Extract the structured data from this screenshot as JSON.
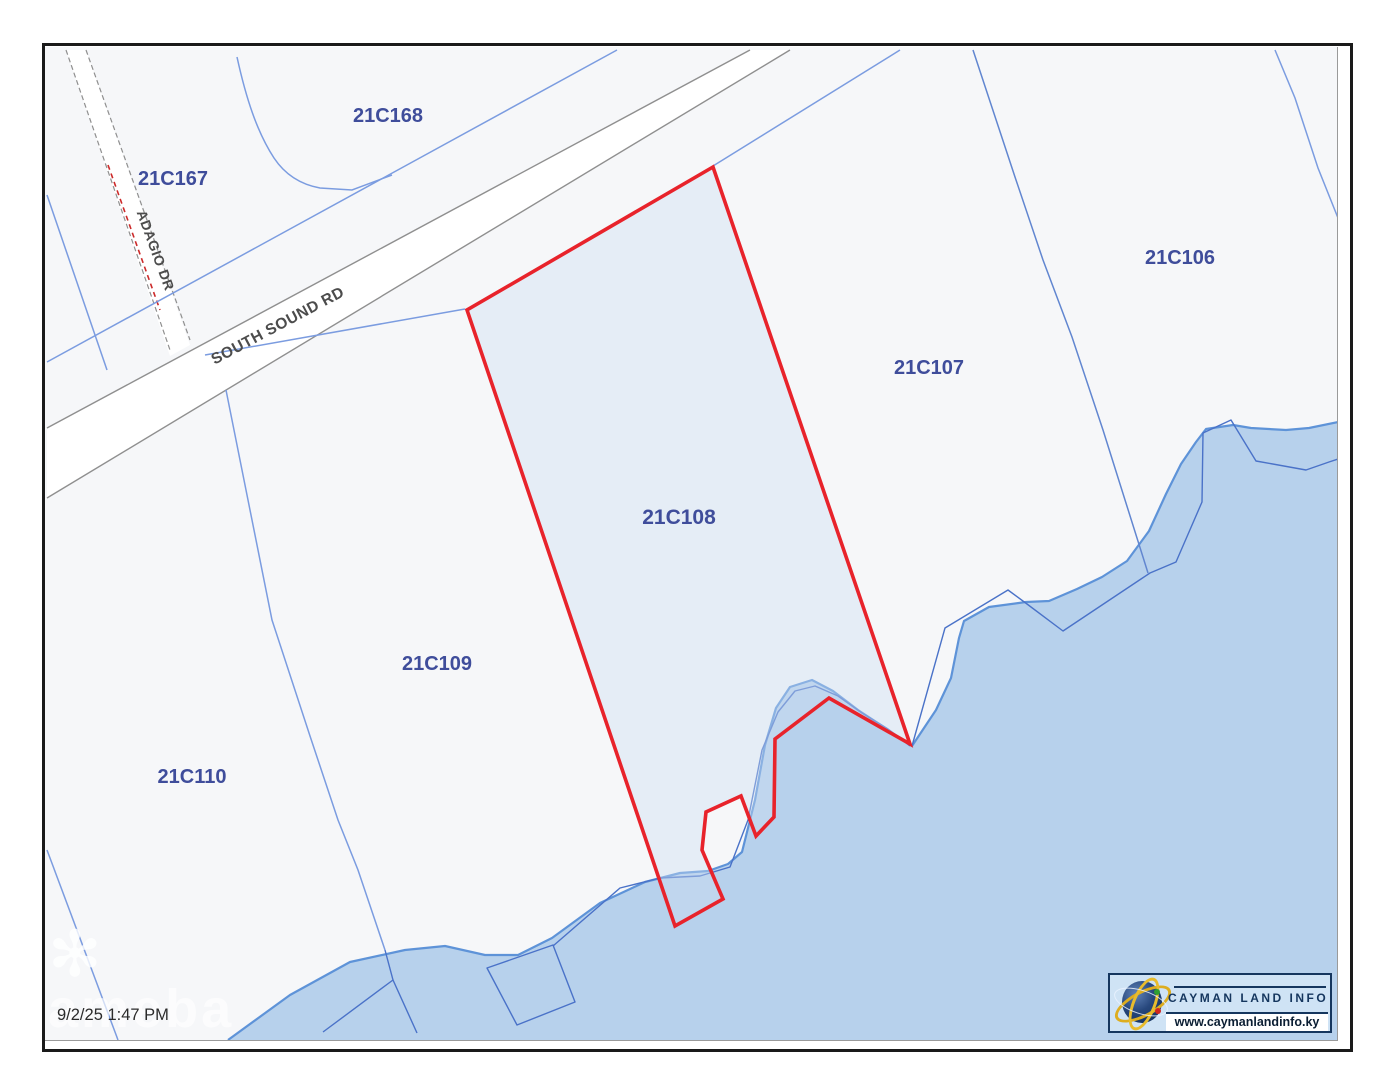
{
  "page": {
    "timestamp": "9/2/25 1:47 PM",
    "watermark_text": "ameba",
    "watermark_icon": "flower-icon"
  },
  "parcels": [
    {
      "id": "21C167"
    },
    {
      "id": "21C168"
    },
    {
      "id": "21C106"
    },
    {
      "id": "21C107"
    },
    {
      "id": "21C108"
    },
    {
      "id": "21C109"
    },
    {
      "id": "21C110"
    }
  ],
  "selected_parcel": {
    "id": "21C108"
  },
  "roads": [
    {
      "name": "SOUTH SOUND RD"
    },
    {
      "name": "ADAGIO DR"
    }
  ],
  "logo": {
    "title": "CAYMAN LAND INFO",
    "website": "www.caymanlandinfo.ky"
  },
  "colors": {
    "land": "#f6f7f9",
    "water": "#b7d1ec",
    "coastline": "#5e93d8",
    "parcel_line": "#7b9ce0",
    "cadastral_water_line": "#4a72c8",
    "selected_parcel_outline": "#e8232b",
    "parcel_label": "#3f4d9b",
    "road_label": "#4c4c4c",
    "road_edge": "#8f8f8f"
  }
}
